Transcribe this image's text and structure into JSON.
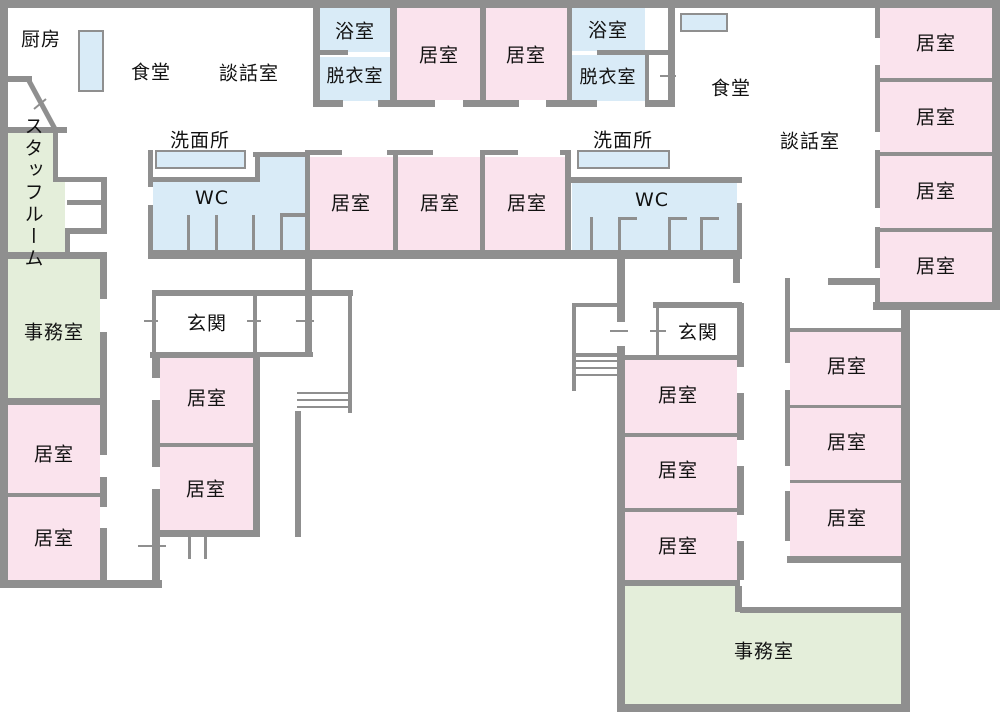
{
  "document": {
    "kind": "floor-plan",
    "language": "ja"
  },
  "colors": {
    "resident-room-fill": "#fae3ed",
    "wet-area-fill": "#d9ebf7",
    "office-fill": "#e4eeda",
    "wall": "#8f8f8f",
    "background": "#ffffff",
    "text": "#111111"
  },
  "labels": {
    "kitchen": "厨房",
    "dining_hall": "食堂",
    "lounge": "談話室",
    "bathroom": "浴室",
    "changing_room": "脱衣室",
    "washroom": "洗面所",
    "toilet": "WC",
    "staff_room": "スタッフルーム",
    "office": "事務室",
    "entrance": "玄関",
    "resident_room": "居室"
  },
  "room_inventory": {
    "resident_room": 19,
    "bathroom": 2,
    "changing_room": 2,
    "toilet": 2,
    "washroom": 2,
    "office": 2,
    "entrance": 2,
    "dining_hall": 2,
    "lounge": 2,
    "kitchen": 1,
    "staff_room": 1
  }
}
